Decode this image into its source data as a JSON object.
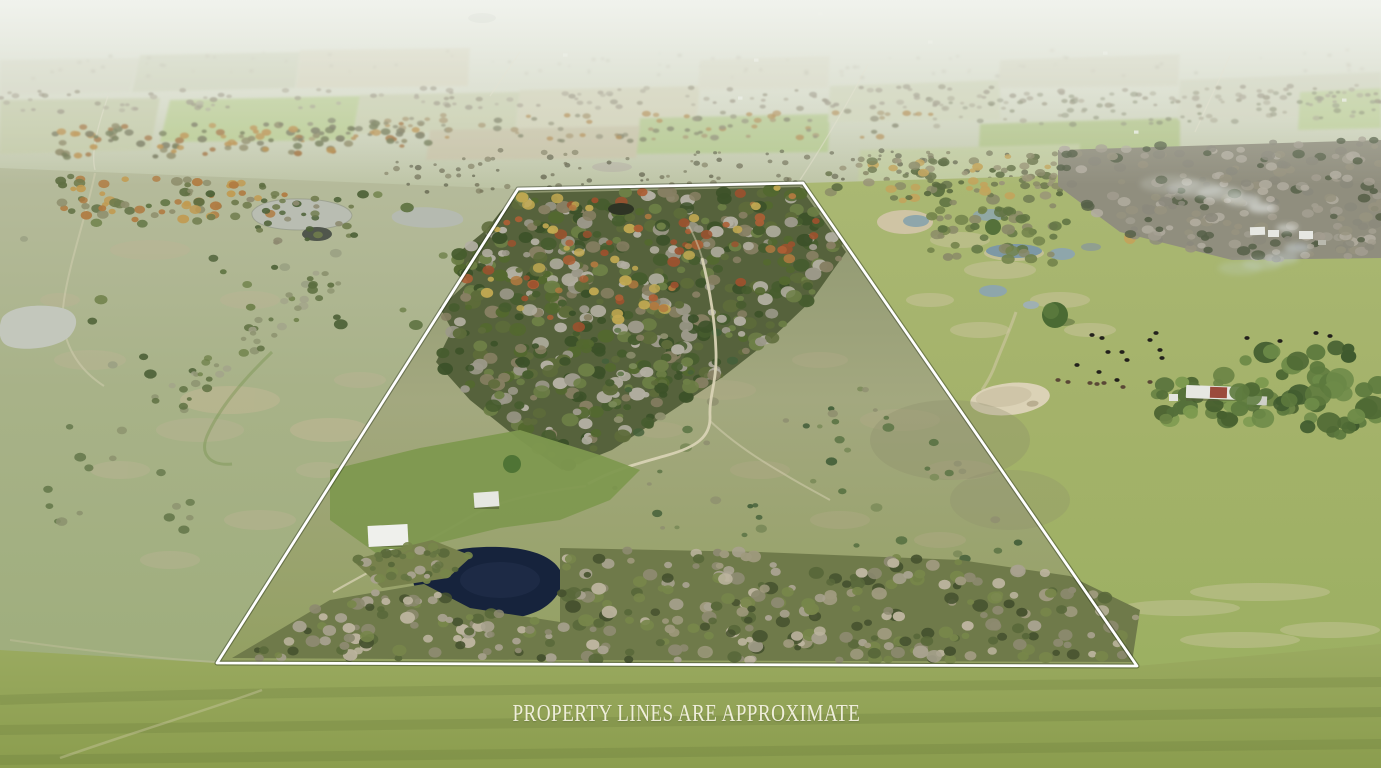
{
  "caption": {
    "text": "PROPERTY LINES ARE APPROXIMATE"
  },
  "boundary": {
    "points": "518,189 803,183 1137,666 217,663",
    "description": "white outlined property boundary"
  },
  "colors": {
    "sky": "#e9ece6",
    "farfield": "#cfd3bc",
    "leftfield": "#b6bb9c",
    "leftfield-low": "#9fae7d",
    "rightfield": "#aab873",
    "rightfield-low": "#9cb062",
    "property-top": "#8e9670",
    "property-mid": "#a3a87f",
    "property-low": "#93a062",
    "lawn": "#7e984f",
    "foreground": "#9aaa60",
    "foreground-low": "#8b9d4e",
    "woods-under": "#56623c",
    "band-under": "#6f7a4a",
    "pond-dark": "#16233c",
    "pond-gray": "#b9bdb2",
    "pond-sand": "#dbd2b6",
    "puddle-blue": "#8ea6ab",
    "dirt": "#d8d2b4",
    "line": "#ffffff",
    "caption": "#efeeda",
    "cattle": "#23211c",
    "barn-red": "#9b4a3c",
    "roof-white": "#e6e7e2"
  },
  "features": {
    "cattle_positions": [
      [
        1092,
        335,
        0
      ],
      [
        1102,
        338,
        0
      ],
      [
        1150,
        340,
        0
      ],
      [
        1156,
        333,
        0
      ],
      [
        1247,
        338,
        0
      ],
      [
        1160,
        350,
        0
      ],
      [
        1108,
        352,
        0
      ],
      [
        1122,
        352,
        0
      ],
      [
        1077,
        365,
        0
      ],
      [
        1127,
        360,
        0
      ],
      [
        1162,
        358,
        0
      ],
      [
        1099,
        372,
        0
      ],
      [
        1117,
        380,
        0
      ],
      [
        1058,
        380,
        1
      ],
      [
        1068,
        382,
        1
      ],
      [
        1090,
        383,
        1
      ],
      [
        1097,
        384,
        1
      ],
      [
        1104,
        383,
        1
      ],
      [
        1123,
        387,
        1
      ],
      [
        1150,
        382,
        1
      ],
      [
        1316,
        333,
        0
      ],
      [
        1330,
        336,
        0
      ],
      [
        1280,
        341,
        0
      ]
    ],
    "distant_building_positions": [
      [
        740,
        98
      ],
      [
        756,
        60
      ],
      [
        930,
        42
      ],
      [
        1022,
        184
      ],
      [
        1105,
        53
      ],
      [
        565,
        55
      ],
      [
        820,
        14
      ],
      [
        1344,
        100
      ],
      [
        470,
        17
      ],
      [
        1136,
        132
      ]
    ]
  },
  "scene": {
    "scatters": [
      {
        "target": "sc-haze-specks",
        "seed": 7,
        "count": 90,
        "rmin": 1,
        "rmax": 2.5,
        "squash": 0.7,
        "opacity": 0.5,
        "palette": [
          "#b7b2a2",
          "#c1bcab",
          "#aaa695"
        ],
        "region": [
          [
            0,
            52
          ],
          [
            1381,
            48
          ],
          [
            1381,
            76
          ],
          [
            0,
            80
          ]
        ]
      },
      {
        "target": "sc-far-a",
        "seed": 11,
        "count": 170,
        "rmin": 2,
        "rmax": 4,
        "squash": 0.65,
        "opacity": 0.8,
        "palette": [
          "#a09a88",
          "#938d7b",
          "#aba793",
          "#8f8a74"
        ],
        "region": [
          [
            0,
            90
          ],
          [
            1381,
            84
          ],
          [
            1381,
            106
          ],
          [
            0,
            112
          ]
        ]
      },
      {
        "target": "sc-far-green-right",
        "seed": 13,
        "count": 90,
        "rmin": 2,
        "rmax": 4,
        "squash": 0.65,
        "opacity": 0.7,
        "palette": [
          "#7f8468",
          "#8f927a",
          "#a5a28c"
        ],
        "region": [
          [
            900,
            96
          ],
          [
            1381,
            88
          ],
          [
            1381,
            120
          ],
          [
            900,
            128
          ]
        ]
      },
      {
        "target": "sc-far-b",
        "seed": 17,
        "count": 110,
        "rmin": 2,
        "rmax": 4.5,
        "squash": 0.65,
        "opacity": 0.85,
        "palette": [
          "#8e8d74",
          "#7b7d62",
          "#a5946d",
          "#b08a50"
        ],
        "region": [
          [
            300,
            116
          ],
          [
            940,
            110
          ],
          [
            940,
            138
          ],
          [
            300,
            144
          ]
        ]
      },
      {
        "target": "sc-fall-left",
        "seed": 19,
        "count": 110,
        "rmin": 2.5,
        "rmax": 5,
        "squash": 0.7,
        "opacity": 0.9,
        "palette": [
          "#75765c",
          "#a06f3d",
          "#8a8562",
          "#b98e4a",
          "#6d7550"
        ],
        "region": [
          [
            55,
            126
          ],
          [
            430,
            122
          ],
          [
            430,
            152
          ],
          [
            55,
            158
          ]
        ]
      },
      {
        "target": "sc-left-fall",
        "seed": 23,
        "count": 70,
        "rmin": 3,
        "rmax": 6,
        "squash": 0.75,
        "opacity": 0.95,
        "palette": [
          "#6f7b4c",
          "#b07b41",
          "#8e8e6c",
          "#5f6f42",
          "#c19a50"
        ],
        "region": [
          [
            58,
            176
          ],
          [
            300,
            182
          ],
          [
            262,
            224
          ],
          [
            58,
            218
          ]
        ]
      },
      {
        "target": "sc-pond-rim",
        "seed": 29,
        "count": 30,
        "rmin": 2.5,
        "rmax": 5,
        "squash": 0.7,
        "opacity": 0.95,
        "palette": [
          "#4e6238",
          "#6f7b4c",
          "#8d8a70"
        ],
        "region": [
          [
            236,
            194
          ],
          [
            362,
            192
          ],
          [
            370,
            238
          ],
          [
            300,
            250
          ],
          [
            236,
            232
          ]
        ]
      },
      {
        "target": "sc-left-trees",
        "seed": 31,
        "count": 30,
        "rmin": 3,
        "rmax": 7,
        "squash": 0.72,
        "opacity": 0.95,
        "palette": [
          "#5f7342",
          "#6f814a",
          "#9aa083",
          "#4e6238"
        ],
        "region": [
          [
            12,
            184
          ],
          [
            500,
            198
          ],
          [
            424,
            330
          ],
          [
            160,
            400
          ],
          [
            26,
            352
          ]
        ]
      },
      {
        "target": "sc-left-diag",
        "seed": 37,
        "count": 48,
        "rmin": 2.5,
        "rmax": 5.5,
        "squash": 0.75,
        "opacity": 0.9,
        "palette": [
          "#6f814a",
          "#8d9370",
          "#5d6f40",
          "#a3a48a"
        ],
        "region": [
          [
            150,
            398
          ],
          [
            316,
            266
          ],
          [
            344,
            282
          ],
          [
            178,
            416
          ]
        ]
      },
      {
        "target": "sc-left-low",
        "seed": 41,
        "count": 16,
        "rmin": 3,
        "rmax": 6,
        "squash": 0.75,
        "opacity": 0.9,
        "palette": [
          "#64774a",
          "#8c926e"
        ],
        "region": [
          [
            20,
            430
          ],
          [
            120,
            420
          ],
          [
            260,
            560
          ],
          [
            140,
            600
          ],
          [
            12,
            520
          ]
        ]
      },
      {
        "target": "sc-scrub-band",
        "seed": 43,
        "count": 130,
        "rmin": 1.5,
        "rmax": 3.5,
        "squash": 0.8,
        "opacity": 0.7,
        "palette": [
          "#6b6a52",
          "#7d7a5e",
          "#585944"
        ],
        "region": [
          [
            380,
            150
          ],
          [
            1068,
            150
          ],
          [
            1068,
            192
          ],
          [
            380,
            192
          ]
        ]
      },
      {
        "target": "sc-mid-treeline-right",
        "seed": 47,
        "count": 120,
        "rmin": 3,
        "rmax": 6,
        "squash": 0.7,
        "opacity": 0.95,
        "palette": [
          "#6e7950",
          "#8a8a68",
          "#5a6a40",
          "#c2a45c",
          "#9a9578"
        ],
        "region": [
          [
            824,
            162
          ],
          [
            1160,
            152
          ],
          [
            1160,
            202
          ],
          [
            824,
            200
          ]
        ]
      },
      {
        "target": "sc-ne-gray",
        "seed": 53,
        "count": 230,
        "rmin": 3.5,
        "rmax": 7,
        "squash": 0.7,
        "opacity": 0.92,
        "palette": [
          "#a39e90",
          "#b2ada0",
          "#8b897c",
          "#97937f",
          "#566048"
        ],
        "region": [
          [
            1058,
            148
          ],
          [
            1381,
            138
          ],
          [
            1381,
            258
          ],
          [
            1232,
            260
          ],
          [
            1120,
            232
          ],
          [
            1058,
            186
          ]
        ]
      },
      {
        "target": "sc-right-mid-trees",
        "seed": 59,
        "count": 55,
        "rmin": 3.5,
        "rmax": 7,
        "squash": 0.75,
        "opacity": 0.95,
        "palette": [
          "#5f7342",
          "#72824a",
          "#8a8a68"
        ],
        "region": [
          [
            928,
            196
          ],
          [
            1070,
            200
          ],
          [
            1060,
            264
          ],
          [
            928,
            258
          ]
        ]
      },
      {
        "target": "sc-farmstead-trees",
        "seed": 61,
        "count": 42,
        "rmin": 5,
        "rmax": 11,
        "squash": 0.8,
        "opacity": 1,
        "palette": [
          "#55703a",
          "#6b8445",
          "#7d9a50",
          "#47602f"
        ],
        "region": [
          [
            1148,
            360
          ],
          [
            1282,
            368
          ],
          [
            1302,
            422
          ],
          [
            1158,
            422
          ]
        ]
      },
      {
        "target": "sc-right-edge-trees",
        "seed": 67,
        "count": 45,
        "rmin": 6,
        "rmax": 14,
        "squash": 0.85,
        "opacity": 1,
        "palette": [
          "#4f6a35",
          "#5d7a3e",
          "#6d8a48",
          "#3f5a2e"
        ],
        "region": [
          [
            1225,
            352
          ],
          [
            1332,
            342
          ],
          [
            1381,
            362
          ],
          [
            1381,
            434
          ],
          [
            1295,
            442
          ],
          [
            1228,
            404
          ]
        ]
      },
      {
        "target": "sc-woods",
        "seed": 71,
        "count": 560,
        "rmin": 3.5,
        "rmax": 8.5,
        "squash": 0.78,
        "opacity": 1,
        "palette": [
          "#3c5129",
          "#53682f",
          "#6d7f46",
          "#465c2e",
          "#9c998a",
          "#b3afa2",
          "#5d6b3a",
          "#877f63"
        ],
        "region": [
          [
            520,
            193
          ],
          [
            800,
            187
          ],
          [
            846,
            252
          ],
          [
            812,
            300
          ],
          [
            770,
            340
          ],
          [
            724,
            376
          ],
          [
            670,
            412
          ],
          [
            612,
            450
          ],
          [
            562,
            470
          ],
          [
            520,
            440
          ],
          [
            470,
            400
          ],
          [
            436,
            362
          ],
          [
            452,
            330
          ],
          [
            440,
            308
          ],
          [
            468,
            282
          ],
          [
            452,
            258
          ],
          [
            486,
            230
          ],
          [
            500,
            212
          ]
        ]
      },
      {
        "target": "sc-woods-fall",
        "seed": 73,
        "count": 90,
        "rmin": 3,
        "rmax": 6.5,
        "squash": 0.8,
        "opacity": 0.95,
        "palette": [
          "#b27a40",
          "#9c512e",
          "#c2a952",
          "#ad5f35"
        ],
        "region": [
          [
            520,
            193
          ],
          [
            800,
            187
          ],
          [
            838,
            248
          ],
          [
            700,
            302
          ],
          [
            560,
            332
          ],
          [
            470,
            302
          ],
          [
            452,
            258
          ],
          [
            486,
            230
          ],
          [
            500,
            212
          ]
        ]
      },
      {
        "target": "sc-open-shrubs",
        "seed": 79,
        "count": 60,
        "rmin": 2.5,
        "rmax": 6,
        "squash": 0.72,
        "opacity": 0.95,
        "palette": [
          "#45603a",
          "#5a7344",
          "#7a8a58",
          "#8f9070"
        ],
        "region": [
          [
            600,
            330
          ],
          [
            842,
            332
          ],
          [
            1062,
            560
          ],
          [
            880,
            560
          ],
          [
            600,
            520
          ]
        ]
      },
      {
        "target": "sc-band-east",
        "seed": 83,
        "count": 270,
        "rmin": 3.5,
        "rmax": 8,
        "squash": 0.8,
        "opacity": 1,
        "palette": [
          "#a8a28f",
          "#bcb49e",
          "#77864a",
          "#59683a",
          "#8d8a70",
          "#46522f",
          "#9f9a7e"
        ],
        "region": [
          [
            560,
            548
          ],
          [
            760,
            552
          ],
          [
            960,
            560
          ],
          [
            1070,
            576
          ],
          [
            1140,
            610
          ],
          [
            1132,
            662
          ],
          [
            560,
            660
          ]
        ]
      },
      {
        "target": "sc-band-west",
        "seed": 89,
        "count": 90,
        "rmin": 3.5,
        "rmax": 7.5,
        "squash": 0.8,
        "opacity": 1,
        "palette": [
          "#a8a28f",
          "#bcb49e",
          "#77864a",
          "#59683a",
          "#8d8a70",
          "#46522f"
        ],
        "region": [
          [
            330,
            600
          ],
          [
            424,
            584
          ],
          [
            470,
            608
          ],
          [
            560,
            622
          ],
          [
            560,
            660
          ],
          [
            232,
            658
          ]
        ]
      },
      {
        "target": "sc-band-nw",
        "seed": 97,
        "count": 40,
        "rmin": 3,
        "rmax": 6,
        "squash": 0.8,
        "opacity": 1,
        "palette": [
          "#77864a",
          "#59683a",
          "#a8a28f",
          "#657442"
        ],
        "region": [
          [
            352,
            560
          ],
          [
            432,
            540
          ],
          [
            472,
            556
          ],
          [
            448,
            578
          ],
          [
            382,
            588
          ]
        ]
      }
    ]
  }
}
